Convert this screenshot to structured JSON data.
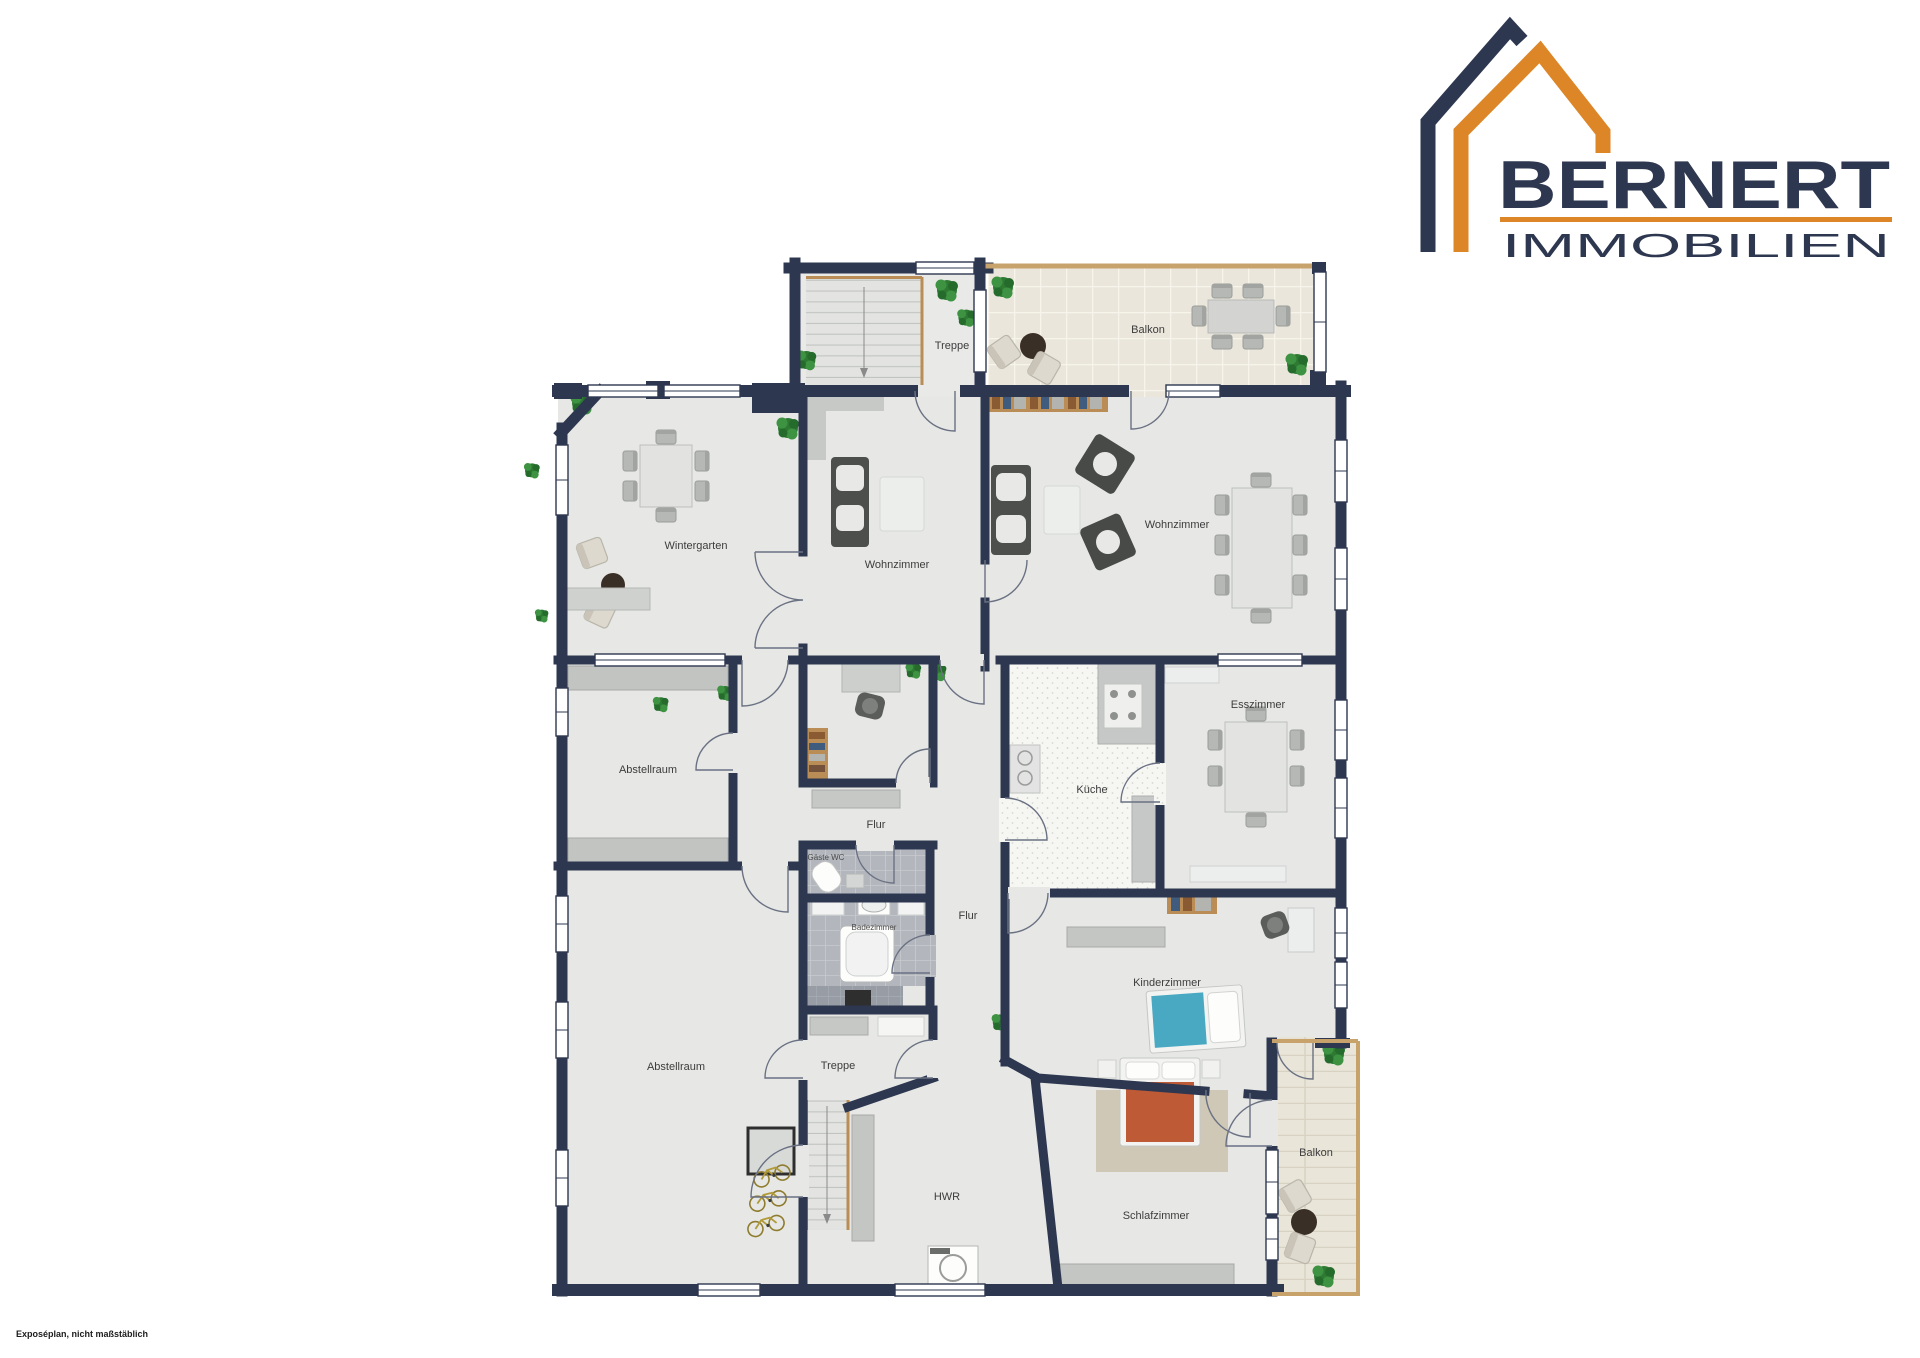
{
  "logo": {
    "brand": "BERNERT",
    "subtitle": "IMMOBILIEN"
  },
  "rooms": {
    "treppe_top": "Treppe",
    "balkon_top": "Balkon",
    "wintergarten": "Wintergarten",
    "wohnzimmer_left": "Wohnzimmer",
    "wohnzimmer_right": "Wohnzimmer",
    "esszimmer": "Esszimmer",
    "kueche": "Küche",
    "abstellraum_mid": "Abstellraum",
    "flur_upper": "Flur",
    "gaeste_wc": "Gäste WC",
    "badezimmer": "Badezimmer",
    "flur_main": "Flur",
    "kinderzimmer": "Kinderzimmer",
    "abstellraum_bottom": "Abstellraum",
    "treppe_bottom": "Treppe",
    "hwr": "HWR",
    "schlafzimmer": "Schlafzimmer",
    "balkon_bottom": "Balkon"
  },
  "footer": {
    "disclaimer": "Exposéplan, nicht maßstäblich"
  },
  "colors": {
    "wall_navy": "#2d3750",
    "brand_orange": "#dd8628",
    "floor": "#e7e8e5",
    "wood": "#b98d55"
  }
}
